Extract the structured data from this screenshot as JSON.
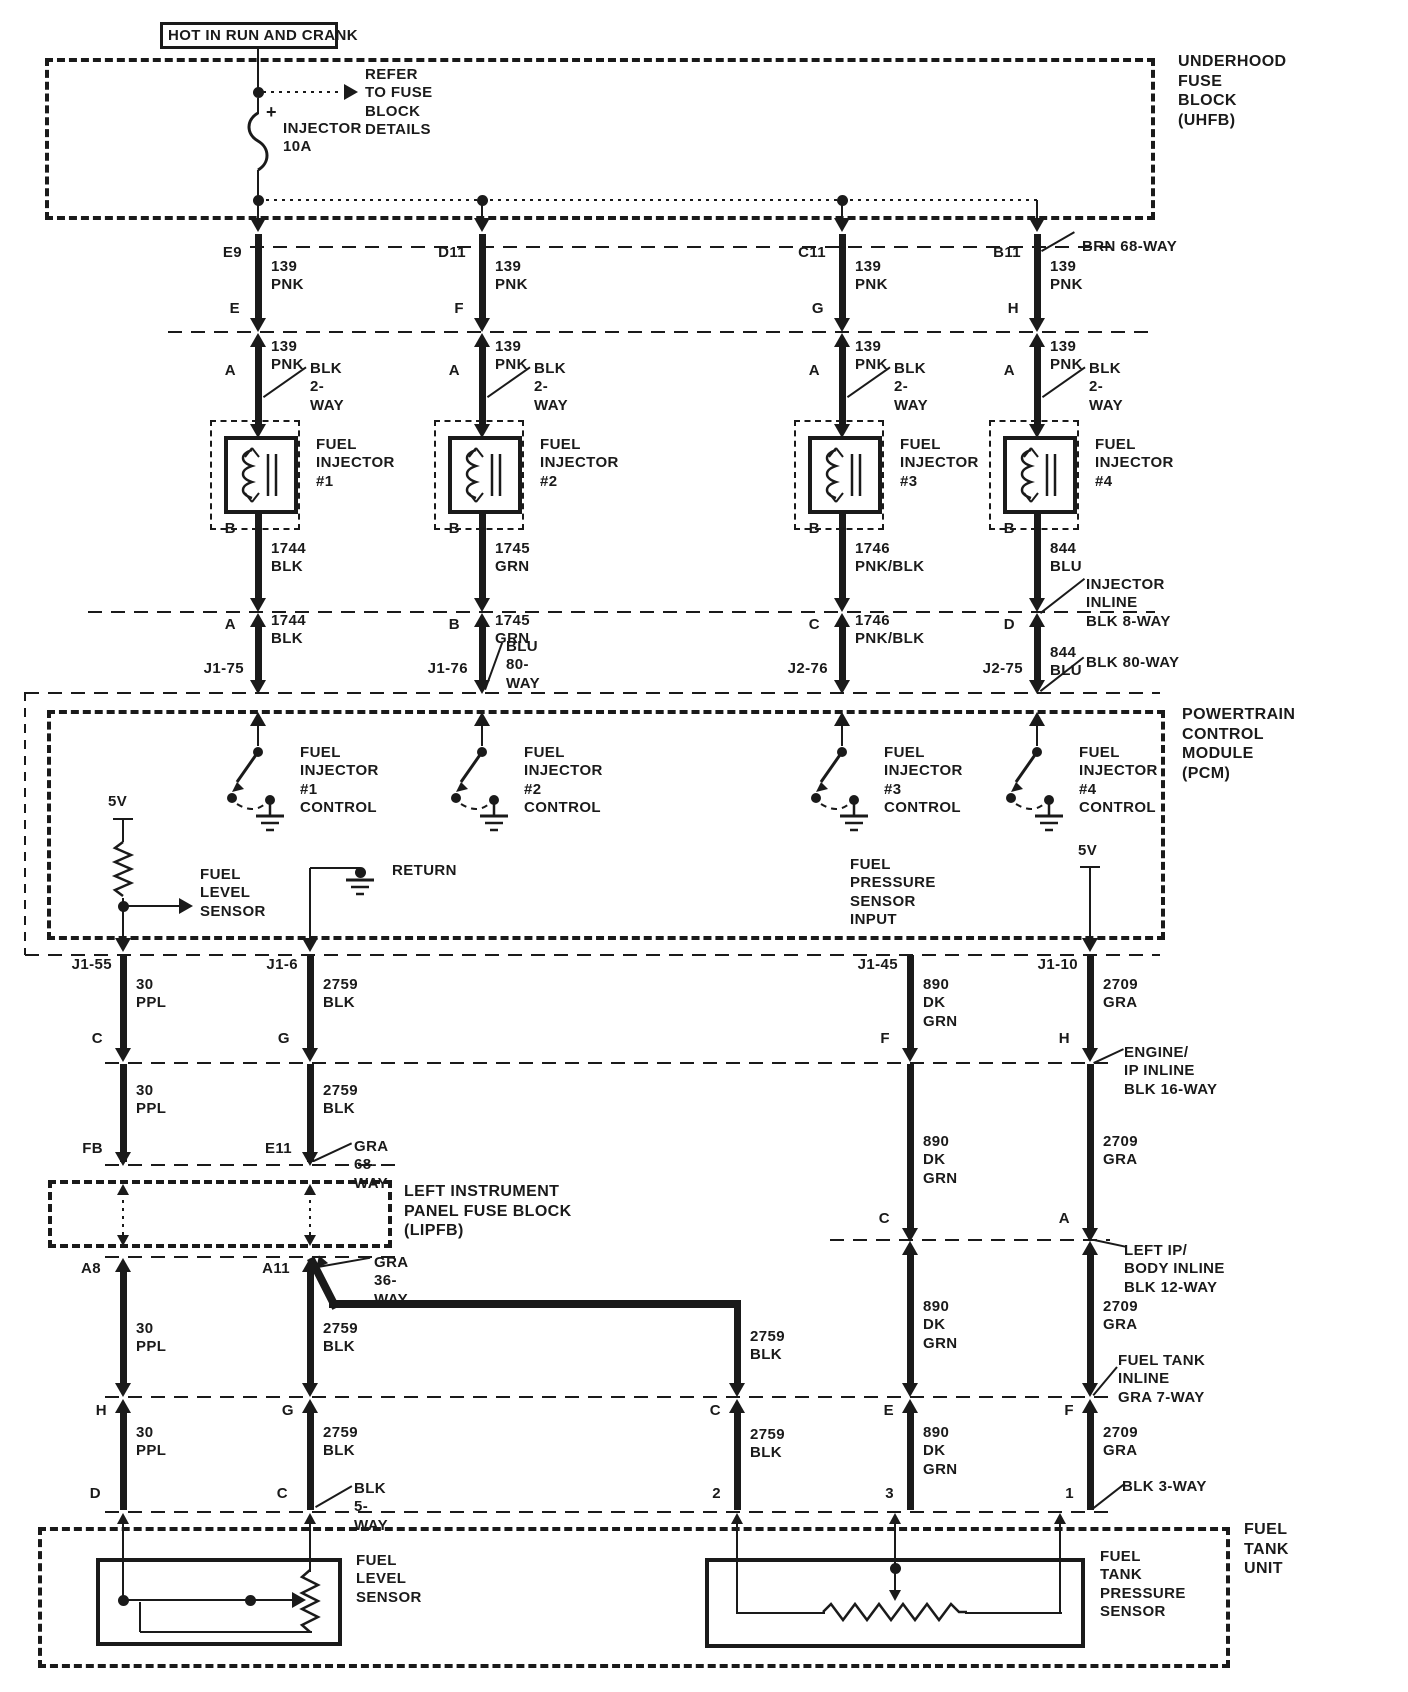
{
  "colors": {
    "ink": "#1a1a1a",
    "paper": "#ffffff"
  },
  "diagram": {
    "hot_label": "HOT IN RUN AND CRANK",
    "uhfb": {
      "label": "UNDERHOOD\nFUSE\nBLOCK\n(UHFB)",
      "fuse_plus": "+",
      "fuse_label": "INJECTOR\n10A",
      "refer_note": "REFER\nTO FUSE\nBLOCK\nDETAILS",
      "connector_label": "BRN 68-WAY"
    },
    "pcm": {
      "label": "POWERTRAIN\nCONTROL\nMODULE\n(PCM)",
      "supply_left": "5V",
      "supply_right": "5V",
      "fuel_level_label": "FUEL\nLEVEL\nSENSOR",
      "return_label": "RETURN",
      "fps_input_label": "FUEL\nPRESSURE\nSENSOR\nINPUT"
    },
    "lipfb": {
      "label": "LEFT INSTRUMENT\nPANEL FUSE BLOCK\n(LIPFB)"
    },
    "ftu": {
      "label": "FUEL\nTANK\nUNIT",
      "level_sensor_label": "FUEL\nLEVEL\nSENSOR",
      "pressure_sensor_label": "FUEL\nTANK\nPRESSURE\nSENSOR"
    }
  },
  "injectors": [
    {
      "uhfb_cavity": "E9",
      "uhfb_term": "E",
      "wire_up": "139\nPNK",
      "wire_mid": "139\nPNK",
      "term_a": "A",
      "conn_2way": "BLK 2-WAY",
      "name": "FUEL\nINJECTOR\n#1",
      "term_b": "B",
      "wire_low": "1744\nBLK",
      "inline_term": "A",
      "wire_inline": "1744\nBLK",
      "pcm_pin": "J1-75",
      "control": "FUEL\nINJECTOR #1\nCONTROL"
    },
    {
      "uhfb_cavity": "D11",
      "uhfb_term": "F",
      "wire_up": "139\nPNK",
      "wire_mid": "139\nPNK",
      "term_a": "A",
      "conn_2way": "BLK 2-WAY",
      "name": "FUEL\nINJECTOR\n#2",
      "term_b": "B",
      "wire_low": "1745\nGRN",
      "inline_term": "B",
      "wire_inline": "1745\nGRN",
      "pcm_pin": "J1-76",
      "control": "FUEL\nINJECTOR #2\nCONTROL"
    },
    {
      "uhfb_cavity": "C11",
      "uhfb_term": "G",
      "wire_up": "139\nPNK",
      "wire_mid": "139\nPNK",
      "term_a": "A",
      "conn_2way": "BLK 2-WAY",
      "name": "FUEL\nINJECTOR\n#3",
      "term_b": "B",
      "wire_low": "1746\nPNK/BLK",
      "inline_term": "C",
      "wire_inline": "1746\nPNK/BLK",
      "pcm_pin": "J2-76",
      "control": "FUEL\nINJECTOR #3\nCONTROL"
    },
    {
      "uhfb_cavity": "B11",
      "uhfb_term": "H",
      "wire_up": "139\nPNK",
      "wire_mid": "139\nPNK",
      "term_a": "A",
      "conn_2way": "BLK 2-WAY",
      "name": "FUEL\nINJECTOR\n#4",
      "term_b": "B",
      "wire_low": "844\nBLU",
      "inline_term": "D",
      "wire_inline": "844\nBLU",
      "pcm_pin": "J2-75",
      "control": "FUEL\nINJECTOR #4\nCONTROL"
    }
  ],
  "callouts": {
    "blu_80": "BLU 80-WAY",
    "blk_80": "BLK 80-WAY",
    "injector_inline": "INJECTOR\nINLINE\nBLK 8-WAY",
    "engine_ip_inline": "ENGINE/\nIP INLINE\nBLK 16-WAY",
    "gra_68": "GRA 68-WAY",
    "gra_36": "GRA 36-WAY",
    "left_ip_inline": "LEFT IP/\nBODY INLINE\nBLK 12-WAY",
    "fuel_tank_inline": "FUEL TANK\nINLINE\nGRA 7-WAY",
    "blk_5": "BLK 5-WAY",
    "blk_3": "BLK 3-WAY"
  },
  "lower_columns": [
    {
      "pin": "J1-55",
      "segments": [
        "30\nPPL",
        "30\nPPL",
        "30\nPPL",
        "30\nPPL"
      ],
      "terminals": [
        "C",
        "FB",
        "A8",
        "H",
        "D"
      ]
    },
    {
      "pin": "J1-6",
      "segments": [
        "2759\nBLK",
        "2759\nBLK",
        "2759\nBLK",
        "2759\nBLK"
      ],
      "terminals": [
        "G",
        "E11",
        "A11",
        "G",
        "C"
      ]
    },
    {
      "segments": [
        "2759\nBLK",
        "2759\nBLK"
      ],
      "terminals": [
        "C",
        "2"
      ]
    },
    {
      "pin": "J1-45",
      "segments": [
        "890\nDK GRN",
        "890\nDK GRN",
        "890\nDK GRN",
        "890\nDK GRN"
      ],
      "terminals": [
        "F",
        "C",
        "E",
        "3"
      ]
    },
    {
      "pin": "J1-10",
      "segments": [
        "2709\nGRA",
        "2709\nGRA",
        "2709\nGRA",
        "2709\nGRA"
      ],
      "terminals": [
        "H",
        "A",
        "F",
        "1"
      ]
    }
  ]
}
